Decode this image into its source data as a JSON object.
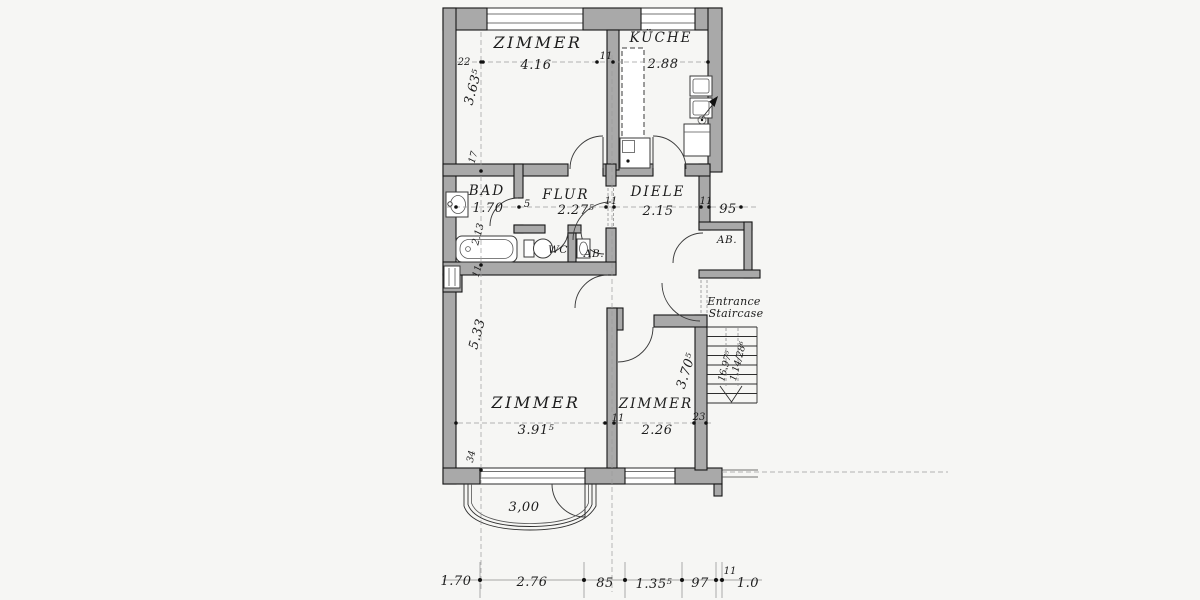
{
  "document": {
    "kind": "apartment floor plan (scanned architectural drawing)"
  },
  "colors": {
    "wall": "#a9a9a9",
    "ink": "#1c1c1c",
    "paper": "#f6f6f4"
  },
  "labels": {
    "zimmer_top": "ZIMMER",
    "zimmer_top_dim": "4.16",
    "tick_22": "22",
    "tick_11_top": "11",
    "kueche": "KÜCHE",
    "kueche_dim": "2.88",
    "dim_363": "3.63⁵",
    "tick_17": "17",
    "bad": "BAD",
    "bad_dim": "1.70",
    "bad_depth": "2.13",
    "tick_11_bad": "11",
    "flur": "FLUR",
    "tick_5": "5",
    "flur_dim": "2.27⁵",
    "tick_11_flur": "11",
    "diele": "DIELE",
    "diele_dim": "2.15",
    "tick_11_diele": "11",
    "dim_95": "95",
    "wc": "WC",
    "ab_small": "AB.",
    "ab_right": "AB.",
    "entrance_1": "Entrance",
    "entrance_2": "Staircase",
    "dim_533": "5.33",
    "tick_34": "34",
    "zimmer_bl": "ZIMMER",
    "zimmer_bl_dim": "3.91⁵",
    "tick_11_bottom": "11",
    "zimmer_br": "ZIMMER",
    "zimmer_br_dim": "2.26",
    "tick_23": "23",
    "zimmer_br_depth": "3.70⁵",
    "stairs_1": "16.97⁵",
    "stairs_2": "1.14/28⁶",
    "balcony_dim": "3,00",
    "bottom_row": [
      "1.70",
      "2.76",
      "85",
      "1.35⁵",
      "97",
      "11",
      "1.0"
    ]
  }
}
